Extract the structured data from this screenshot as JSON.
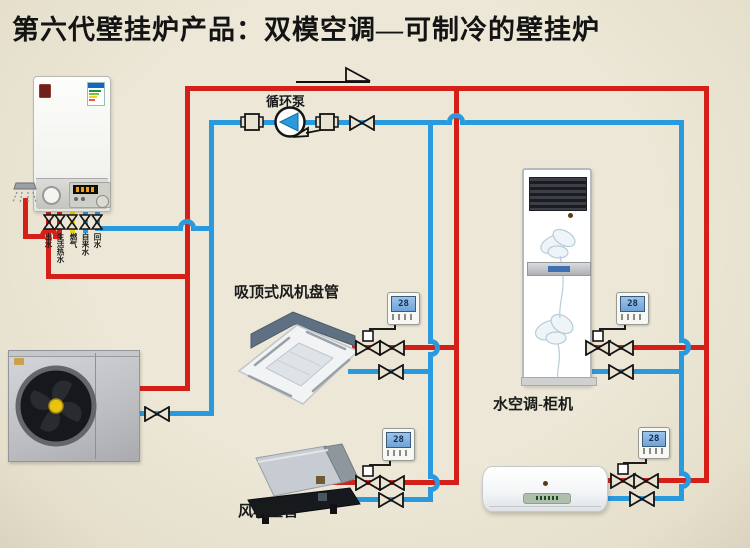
{
  "title": "第六代壁挂炉产品：双模空调—可制冷的壁挂炉",
  "labels": {
    "circulation_pump": "循环泵",
    "ceiling_cassette": "吸顶式风机盘管",
    "fan_coil": "风机盘管",
    "cabinet_ac": "水空调-柜机"
  },
  "boiler_connections": [
    {
      "label": "出水",
      "pipe_color": "#d42018"
    },
    {
      "label": "生活热水",
      "pipe_color": "#d42018"
    },
    {
      "label": "燃气",
      "pipe_color": "#f0d013"
    },
    {
      "label": "自来水",
      "pipe_color": "#2a9ade"
    },
    {
      "label": "回水",
      "pipe_color": "#2a9ade"
    }
  ],
  "thermostats": [
    {
      "location": "ceiling-cassette",
      "value": "28"
    },
    {
      "location": "cabinet-ac",
      "value": "28"
    },
    {
      "location": "fan-coil",
      "value": "28"
    },
    {
      "location": "wall-split",
      "value": "28"
    }
  ],
  "colors": {
    "background": "#e9e3d1",
    "pipe_hot": "#d42018",
    "pipe_cold": "#2a9ade",
    "pipe_gas": "#f0d013",
    "valve_outline": "#141414"
  }
}
